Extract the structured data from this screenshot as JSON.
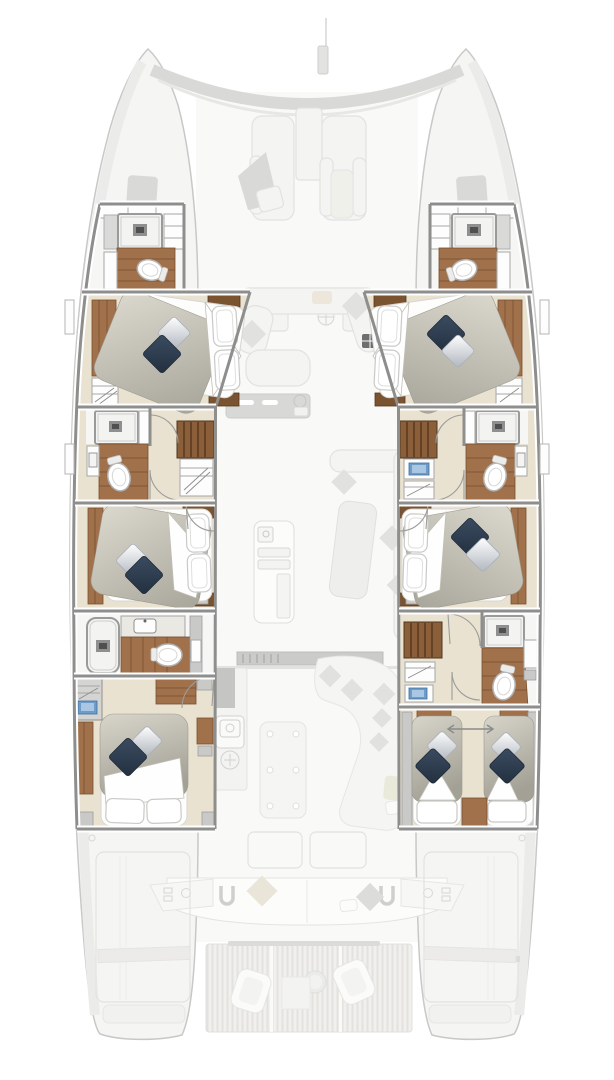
{
  "palette": {
    "hull-fill": "#f5f5f4",
    "hull-line": "#c8c8c7",
    "deck": "#ebebea",
    "faded-fill": "#f4f4f3",
    "faded-line": "#e2e2e1",
    "faded-dark": "#d9d9d8",
    "wall": "#8e8e8d",
    "floor": "#e9e2d1",
    "bath": "#f6f6f5",
    "wood": "#a0714b",
    "wood-dark": "#7a5330",
    "stair": "#8a5f3a",
    "stair-dark": "#5c3b20",
    "navy": "#2e3d4f",
    "silver": "#b6bcc4",
    "blue": "#6f9cc7",
    "blue-dark": "#3f6ea3",
    "marble": "#eae8e3",
    "fix-stroke": "#adadac",
    "gray-box": "#c9c9c8",
    "shower": "#f3f3f2",
    "drain": "#4f4f4f"
  },
  "floorplan": {
    "type": "catamaran overhead deck plan",
    "highlight": "hull accommodation deck",
    "ghosted": "main deck (foredeck, salon, cockpit, swim platform)",
    "foredeck": {
      "sun_loungers": 2,
      "center_hatch": 1
    },
    "salon_ghost": {
      "items": [
        "u-sofa",
        "front-window-band",
        "compass-rose",
        "galley-counter",
        "galley-island",
        "dining-table",
        "corner-bench",
        "skylight-hatch"
      ]
    },
    "cockpit_ghost": {
      "items": [
        "sliding-door",
        "outdoor-galley",
        "grill",
        "table",
        "lounge-sofa",
        "deck-hatches",
        "aft-bench",
        "helm-pods",
        "cleats"
      ]
    },
    "swim_platform_ghost": {
      "items": [
        "teak-platform",
        "armchair",
        "armchair",
        "round-table",
        "mat"
      ]
    },
    "port_hull": {
      "forward_head": [
        "shower",
        "toilet",
        "vanity",
        "lockers"
      ],
      "forward_cabin": [
        "island-double-bed",
        "wardrobe",
        "hanging-locker",
        "nightstands",
        "navy-pillow",
        "silver-pillow"
      ],
      "companionway": [
        "stairs",
        "hanging-locker"
      ],
      "mid_head": [
        "shower",
        "toilet",
        "sink"
      ],
      "mid_cabin": [
        "island-double-bed",
        "wardrobe",
        "nightstands",
        "navy-pillow",
        "silver-pillow"
      ],
      "aft_head": [
        "bathtub-shower",
        "marble-vanity",
        "sink",
        "toilet"
      ],
      "aft_cabin": [
        "double-bed",
        "wardrobes",
        "locker-with-screen",
        "navy-pillow",
        "silver-pillow"
      ]
    },
    "starboard_hull": {
      "forward_head": [
        "shower",
        "toilet",
        "vanity",
        "lockers"
      ],
      "forward_cabin": [
        "island-double-bed",
        "wardrobe",
        "hanging-locker",
        "nightstands",
        "navy-pillow",
        "silver-pillow"
      ],
      "mid_companionway": [
        "stairs",
        "sink-console",
        "hanging-locker"
      ],
      "mid_head": [
        "shower",
        "toilet",
        "sink"
      ],
      "mid_cabin": [
        "island-double-bed",
        "wardrobe",
        "nightstands",
        "navy-pillow",
        "silver-pillow"
      ],
      "aft_companionway": [
        "stairs",
        "hanging-locker",
        "sink-console"
      ],
      "aft_head": [
        "shower",
        "toilet",
        "cabinet"
      ],
      "aft_twin_cabin": [
        "single-bed",
        "single-bed",
        "slide-together-arrow",
        "center-step",
        "navy-pillows",
        "silver-pillows"
      ]
    },
    "counts": {
      "cabins": 6,
      "heads": 6,
      "companionways": 3
    }
  }
}
